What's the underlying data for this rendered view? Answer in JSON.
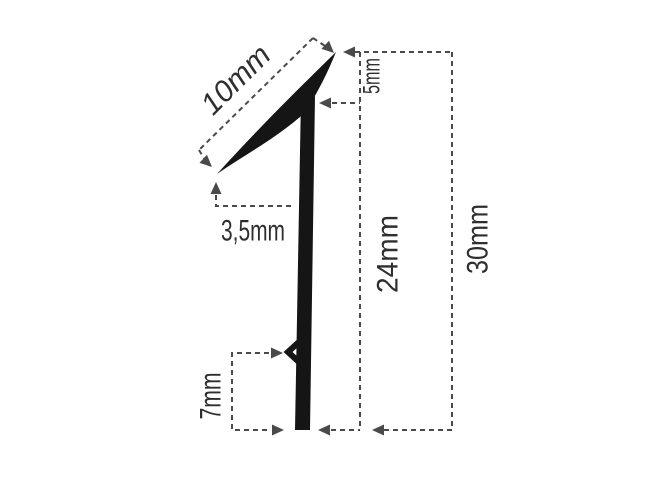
{
  "figure": {
    "kind": "technical-profile-dimension-drawing",
    "units": "mm"
  },
  "dims": {
    "blade_length": "10mm",
    "blade_drop": "5mm",
    "tip_offset": "3,5mm",
    "stem_height": "24mm",
    "overall_height": "30mm",
    "barb_to_bottom": "7mm"
  },
  "colors": {
    "background": "#ffffff",
    "profile": "#151515",
    "dimension": "#4a4a4a",
    "label": "#2e2e2e"
  }
}
